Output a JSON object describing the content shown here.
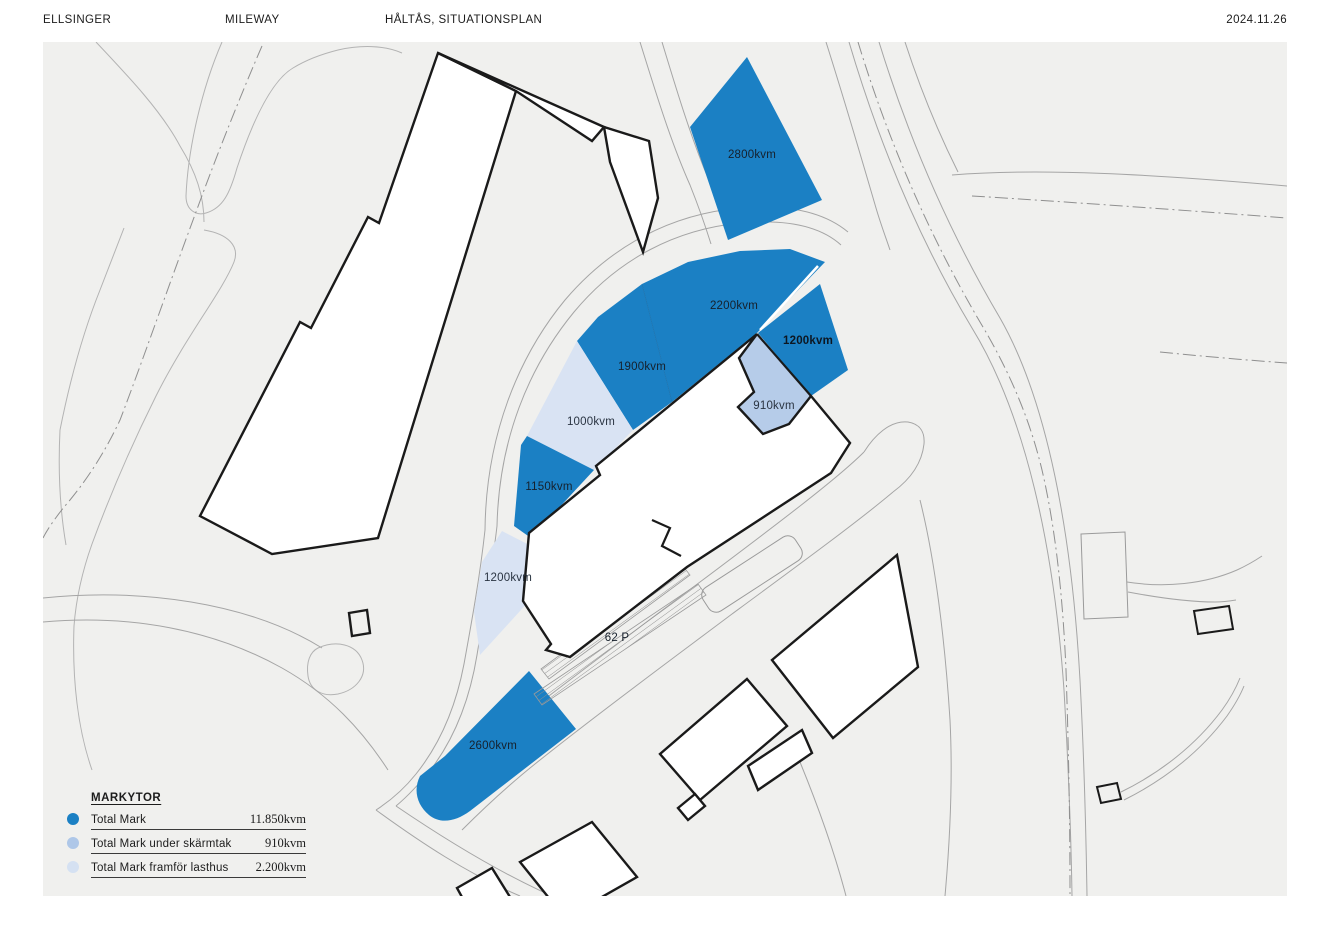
{
  "header": {
    "client": "ELLSINGER",
    "owner": "MILEWAY",
    "title": "HÅLTÅS, SITUATIONSPLAN",
    "date": "2024.11.26"
  },
  "plan": {
    "area_labels": [
      {
        "id": "area-2800",
        "text": "2800kvm",
        "type": "mark"
      },
      {
        "id": "area-2200",
        "text": "2200kvm",
        "type": "mark"
      },
      {
        "id": "area-1900",
        "text": "1900kvm",
        "type": "mark"
      },
      {
        "id": "area-1200-east",
        "text": "1200kvm",
        "type": "mark"
      },
      {
        "id": "area-910",
        "text": "910kvm",
        "type": "canopy"
      },
      {
        "id": "area-1000",
        "text": "1000kvm",
        "type": "loading"
      },
      {
        "id": "area-1150",
        "text": "1150kvm",
        "type": "mark"
      },
      {
        "id": "area-1200-west",
        "text": "1200kvm",
        "type": "loading"
      },
      {
        "id": "area-2600",
        "text": "2600kvm",
        "type": "mark"
      }
    ],
    "parking_label": "62 P"
  },
  "legend": {
    "title": "MARKYTOR",
    "rows": [
      {
        "label": "Total Mark",
        "value": "11.850kvm",
        "color": "#1b80c4"
      },
      {
        "label": "Total Mark under skärmtak",
        "value": "910kvm",
        "color": "#aec7e8"
      },
      {
        "label": "Total Mark framför lasthus",
        "value": "2.200kvm",
        "color": "#d5e1f2"
      }
    ]
  },
  "colors": {
    "mark": "#1b80c4",
    "canopy": "#b6cce9",
    "loading": "#d9e3f3",
    "map_background": "#f0f0ee",
    "building_outline": "#1a1a1a"
  }
}
